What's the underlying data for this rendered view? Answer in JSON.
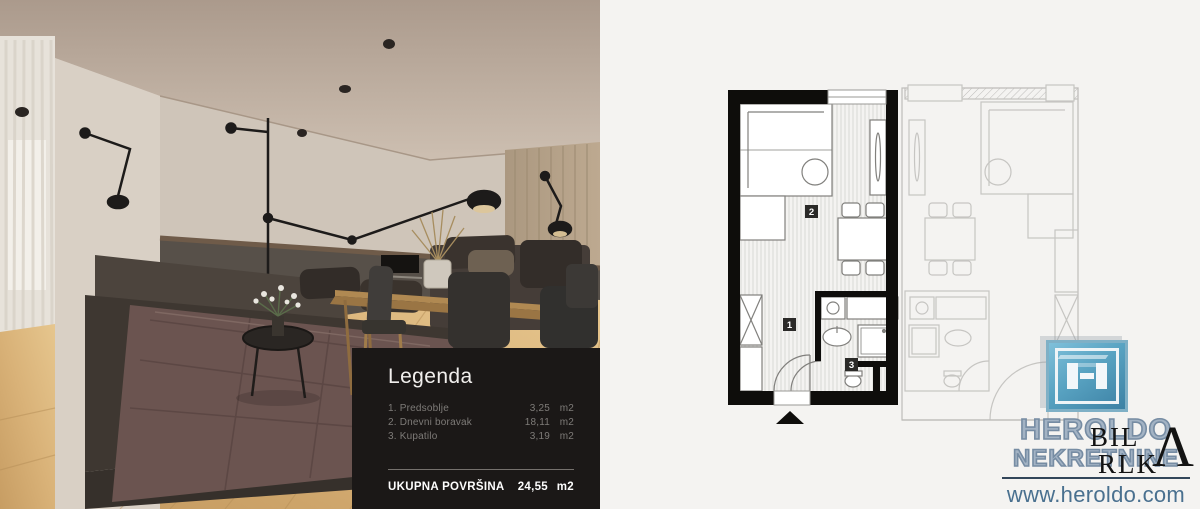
{
  "legend": {
    "title": "Legenda",
    "items": [
      {
        "label": "1. Predsoblje",
        "value": "3,25",
        "unit": "m2"
      },
      {
        "label": "2. Dnevni boravak",
        "value": "18,11",
        "unit": "m2"
      },
      {
        "label": "3. Kupatilo",
        "value": "3,19",
        "unit": "m2"
      }
    ],
    "total": {
      "label": "UKUPNA POVRŠINA",
      "value": "24,55",
      "unit": "m2"
    }
  },
  "plan": {
    "rooms": [
      {
        "number": "1",
        "name": "Predsoblje"
      },
      {
        "number": "2",
        "name": "Dnevni boravak"
      },
      {
        "number": "3",
        "name": "Kupatilo"
      }
    ]
  },
  "brand": {
    "name_line1": "HEROLDO",
    "name_line2": "NEKRETNINE",
    "url": "www.heroldo.com",
    "watermark_line1": "BIL",
    "watermark_line2": "RLK",
    "watermark_accent": "Λ"
  },
  "colors": {
    "legend_background": "#1b1817",
    "plan_background": "#f4f3f1",
    "plan_wall": "#0e0d0b",
    "logo_blue": "#59a3c2",
    "brand_text": "#7f95aa",
    "url_text": "#49708f"
  }
}
